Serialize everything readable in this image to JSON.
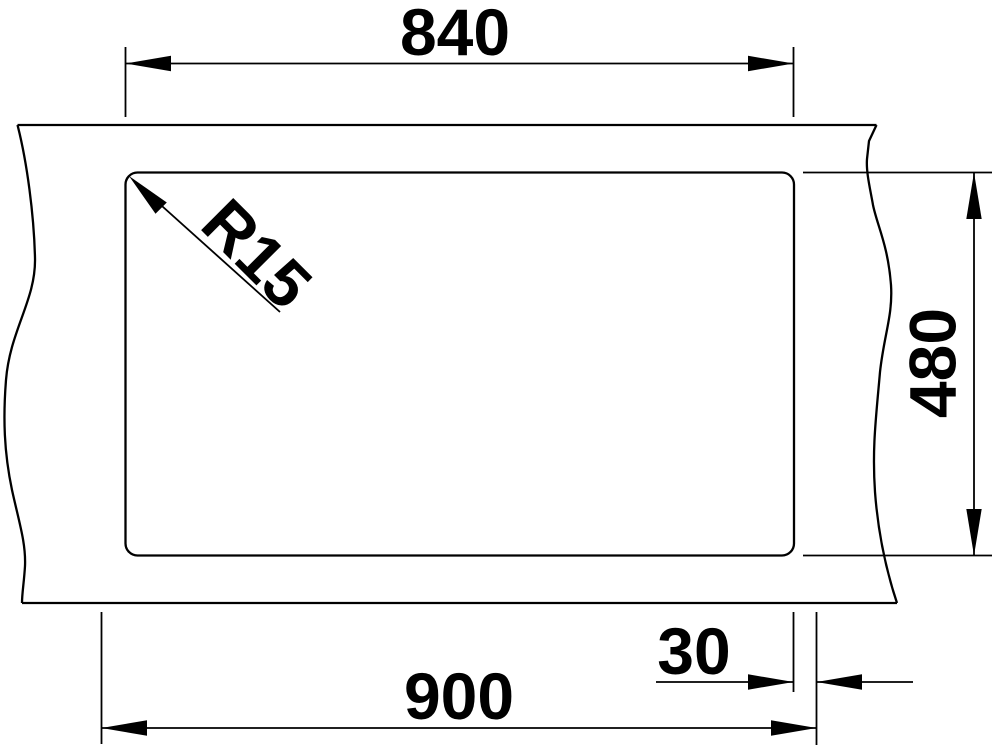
{
  "drawing": {
    "background_color": "#ffffff",
    "line_color": "#000000",
    "labels": {
      "width_top": "840",
      "width_bottom": "900",
      "height_right": "480",
      "offset_right": "30",
      "corner_radius": "R15"
    }
  }
}
